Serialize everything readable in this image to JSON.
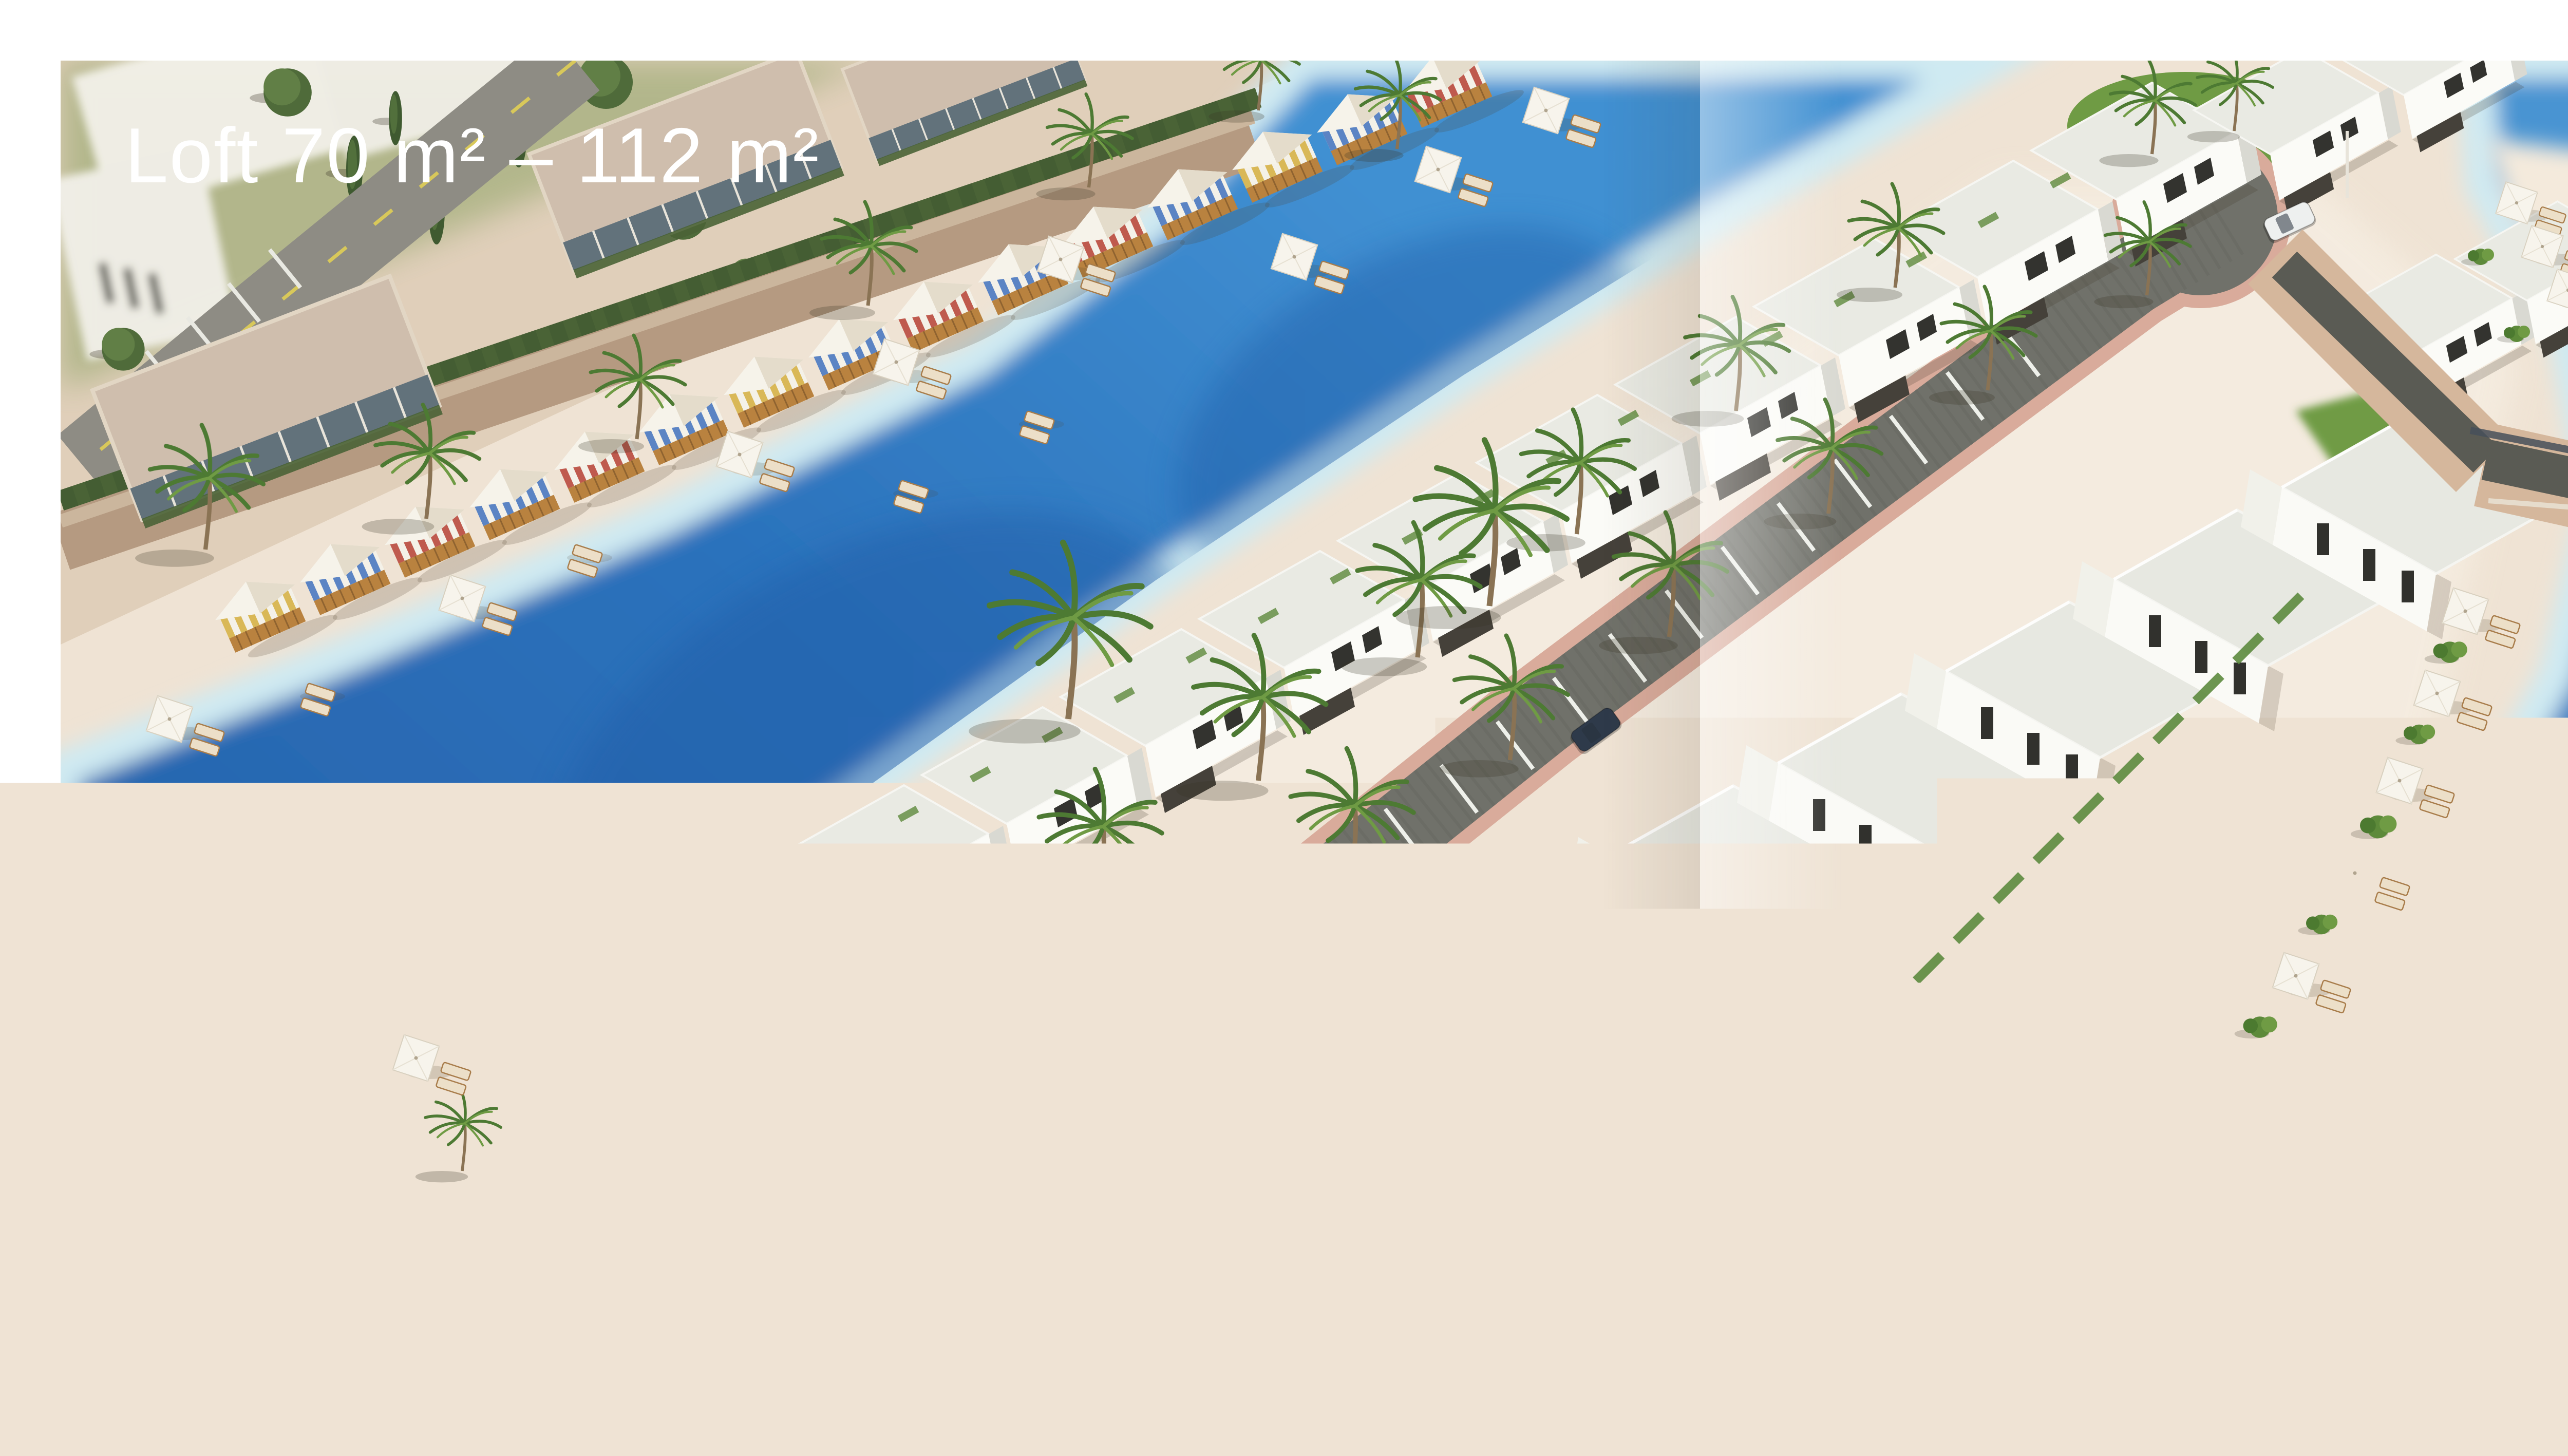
{
  "photo": {
    "caption": "Loft 70 m² – 112 m²",
    "caption_color": "#ffffff"
  },
  "palette": {
    "page_bg": "#ffffff",
    "water_deep": "#2667b1",
    "water_mid": "#3b86cd",
    "water_shallow": "#cfeaf2",
    "sand": "#efe3d4",
    "sand_bright": "#f6eee2",
    "hill_tan": "#e0cfba",
    "grass": "#6f9b44",
    "hedge": "#4a6336",
    "stone_wall": "#b59a81",
    "road_asphalt": "#8e8c84",
    "road_cobble": "#70716a",
    "paver_pink": "#d9ab9b",
    "building_white": "#fafaf7",
    "roof_gray": "#e9eae3",
    "bridge_tan": "#d5b79c",
    "canopy_white": "#f6f3ea",
    "stripe_blue": "#5b84c4",
    "stripe_red": "#bf5a4e",
    "stripe_yellow": "#d9b857",
    "wood": "#b9823f",
    "car_red": "#b5392f",
    "car_dark": "#2e3a4a",
    "car_white": "#eef0ef",
    "road_line_yellow": "#d8c85a",
    "fold_gray": "#c6c6c6"
  }
}
